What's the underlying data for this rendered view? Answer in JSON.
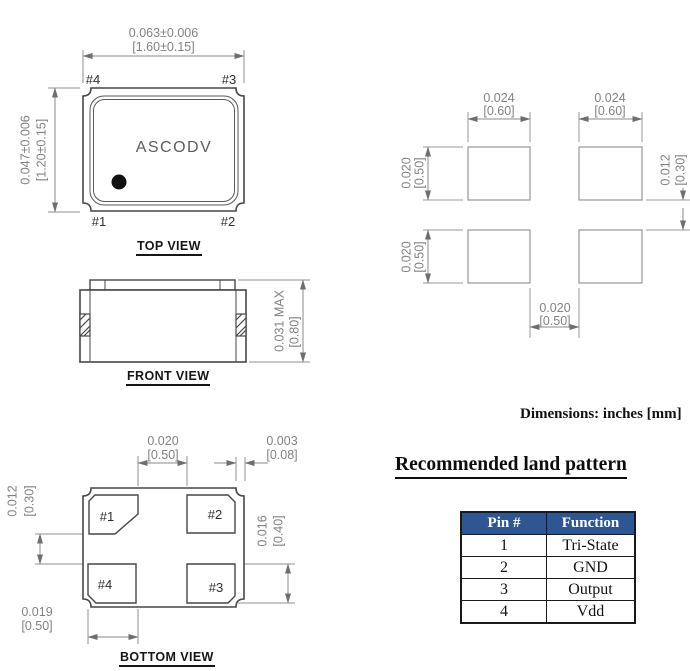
{
  "page": {
    "note": "Dimensions: inches [mm]"
  },
  "top_view": {
    "title": "TOP VIEW",
    "marking": "ASCODV",
    "pin_labels": {
      "p1": "#1",
      "p2": "#2",
      "p3": "#3",
      "p4": "#4"
    },
    "width_dim": {
      "inches": "0.063±0.006",
      "mm": "[1.60±0.15]"
    },
    "height_dim": {
      "inches": "0.047±0.006",
      "mm": "[1.20±0.15]"
    }
  },
  "front_view": {
    "title": "FRONT VIEW",
    "height_dim": {
      "inches": "0.031 MAX",
      "mm": "[0.80]"
    }
  },
  "bottom_view": {
    "title": "BOTTOM VIEW",
    "pad_labels": {
      "p1": "#1",
      "p2": "#2",
      "p3": "#3",
      "p4": "#4"
    },
    "pad_gap_x": {
      "inches": "0.020",
      "mm": "[0.50]"
    },
    "pad_edge_offset": {
      "inches": "0.003",
      "mm": "[0.08]"
    },
    "pad_gap_y": {
      "inches": "0.012",
      "mm": "[0.30]"
    },
    "pad_height": {
      "inches": "0.016",
      "mm": "[0.40]"
    },
    "pad_width": {
      "inches": "0.019",
      "mm": "[0.50]"
    }
  },
  "land_pattern": {
    "heading": "Recommended land pattern",
    "pad_width_left": {
      "inches": "0.024",
      "mm": "[0.60]"
    },
    "pad_width_right": {
      "inches": "0.024",
      "mm": "[0.60]"
    },
    "pad_height_top": {
      "inches": "0.020",
      "mm": "[0.50]"
    },
    "pad_height_bottom": {
      "inches": "0.020",
      "mm": "[0.50]"
    },
    "gap_y": {
      "inches": "0.012",
      "mm": "[0.30]"
    },
    "gap_x": {
      "inches": "0.020",
      "mm": "[0.50]"
    }
  },
  "pin_table": {
    "headers": [
      "Pin #",
      "Function"
    ],
    "rows": [
      [
        "1",
        "Tri-State"
      ],
      [
        "2",
        "GND"
      ],
      [
        "3",
        "Output"
      ],
      [
        "4",
        "Vdd"
      ]
    ],
    "header_bg": "#2e5693",
    "header_fg": "#ffffff"
  }
}
